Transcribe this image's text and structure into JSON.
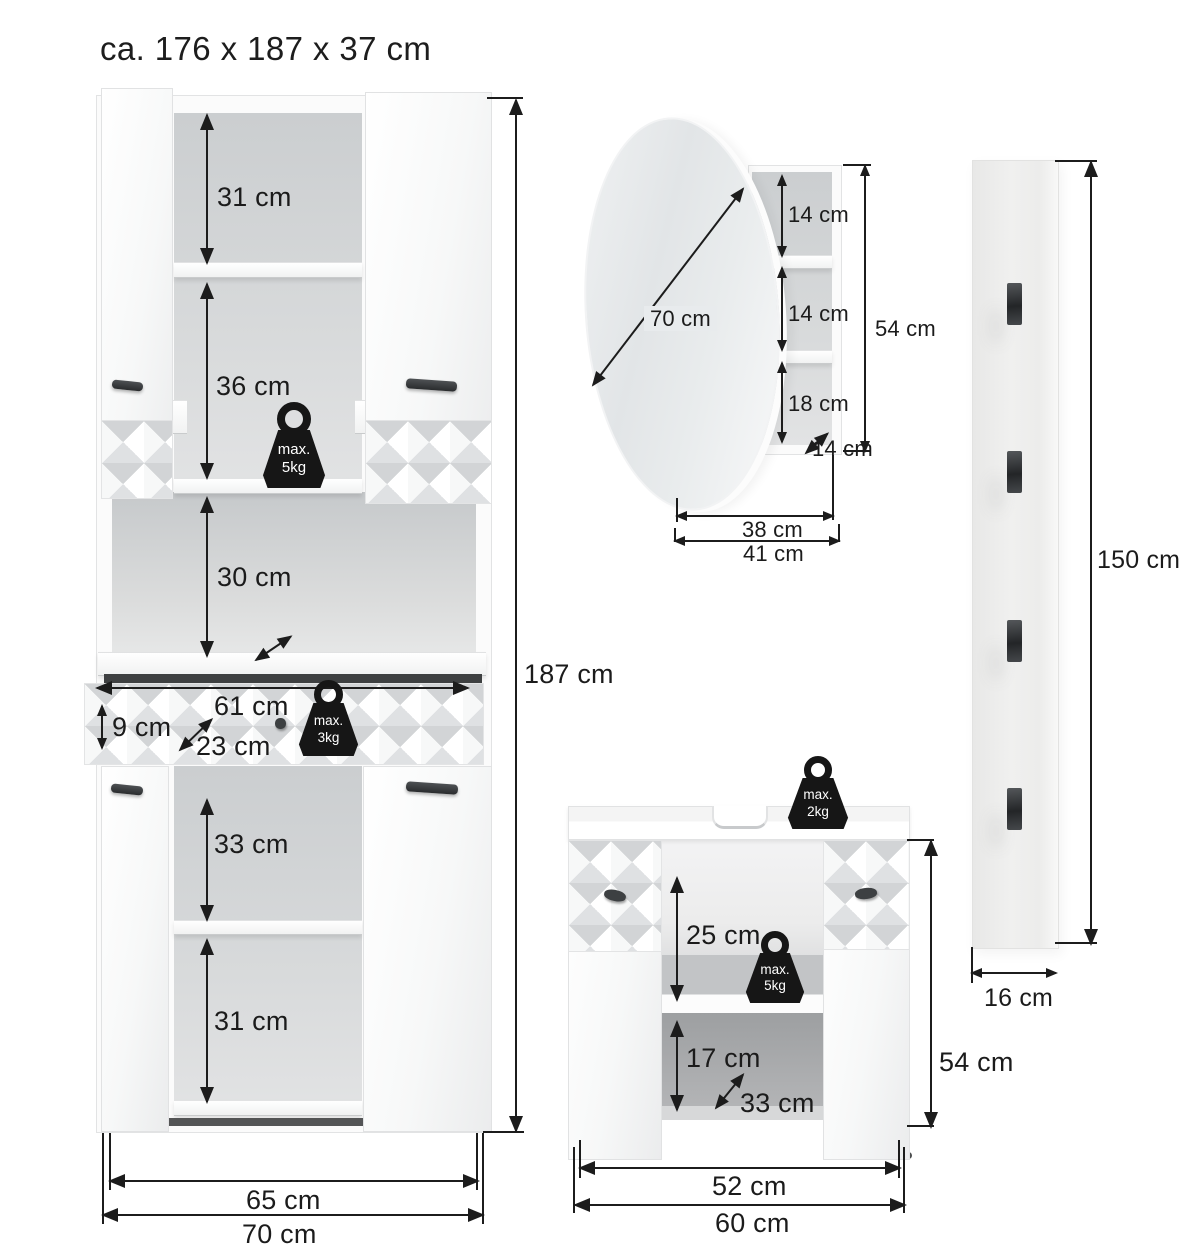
{
  "title": "ca. 176 x 187 x 37 cm",
  "colors": {
    "line": "#1c1c1c",
    "weight_bg": "#161616",
    "interior_gray": "#d5d7d8",
    "surface_white": "#fbfbfb"
  },
  "tall_cabinet": {
    "shelf_top": "31 cm",
    "shelf_mid": "36 cm",
    "niche_height": "30 cm",
    "drawer_width": "61 cm",
    "drawer_height": "9 cm",
    "drawer_depth": "23 cm",
    "lower_shelf": "33 cm",
    "lower_bottom": "31 cm",
    "total_height": "187 cm",
    "inner_width": "65 cm",
    "total_width": "70 cm",
    "weight_shelf": {
      "line1": "max.",
      "line2": "5kg"
    },
    "weight_drawer": {
      "line1": "max.",
      "line2": "3kg"
    }
  },
  "mirror_cabinet": {
    "mirror_diameter": "70 cm",
    "compartment_1": "14 cm",
    "compartment_2": "14 cm",
    "compartment_3": "18 cm",
    "depth": "14 cm",
    "height": "54 cm",
    "inner_width": "38 cm",
    "total_width": "41 cm"
  },
  "wall_panel": {
    "height": "150 cm",
    "width": "16 cm"
  },
  "vanity": {
    "open_height": "25 cm",
    "compartment_height": "17 cm",
    "depth": "33 cm",
    "height": "54 cm",
    "inner_width": "52 cm",
    "total_width": "60 cm",
    "weight_top": {
      "line1": "max.",
      "line2": "2kg"
    },
    "weight_shelf": {
      "line1": "max.",
      "line2": "5kg"
    }
  }
}
